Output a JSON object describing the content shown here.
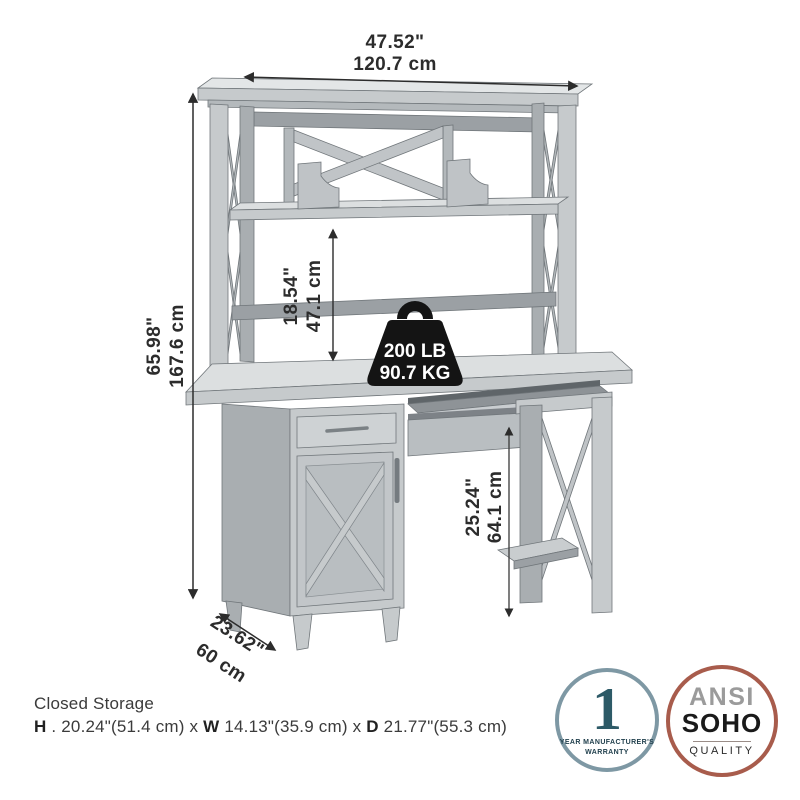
{
  "dimensions": {
    "overall_width_in": "47.52\"",
    "overall_width_cm": "120.7 cm",
    "overall_height_in": "65.98\"",
    "overall_height_cm": "167.6 cm",
    "hutch_clearance_in": "18.54\"",
    "hutch_clearance_cm": "47.1 cm",
    "knee_clearance_in": "25.24\"",
    "knee_clearance_cm": "64.1 cm",
    "depth_in": "23.62\"",
    "depth_cm": "60 cm"
  },
  "weight_capacity": {
    "pounds": "200 LB",
    "kilograms": "90.7 KG"
  },
  "closed_storage": {
    "title": "Closed Storage",
    "h_label": "H",
    "h_value": " . 20.24\"(51.4 cm) x ",
    "w_label": "W",
    "w_value": " 14.13\"(35.9 cm) x ",
    "d_label": "D",
    "d_value": " 21.77\"(55.3 cm)"
  },
  "badges": {
    "warranty": {
      "number": "1",
      "caption_line1": "YEAR MANUFACTURER'S",
      "caption_line2": "WARRANTY"
    },
    "quality": {
      "line1": "ANSI",
      "line2": "SOHO",
      "line3": "QUALITY"
    }
  },
  "colors": {
    "background": "#ffffff",
    "furniture_light": "#dcdfe0",
    "furniture_mid": "#c6cacc",
    "furniture_dark": "#a9aeb1",
    "dimension_ink": "#2c2c2c",
    "weight_black": "#141414",
    "warranty_border": "#7e98a4",
    "warranty_number": "#2d5a67",
    "quality_border": "#a85c4c",
    "quality_gray": "#9b9b9b"
  }
}
